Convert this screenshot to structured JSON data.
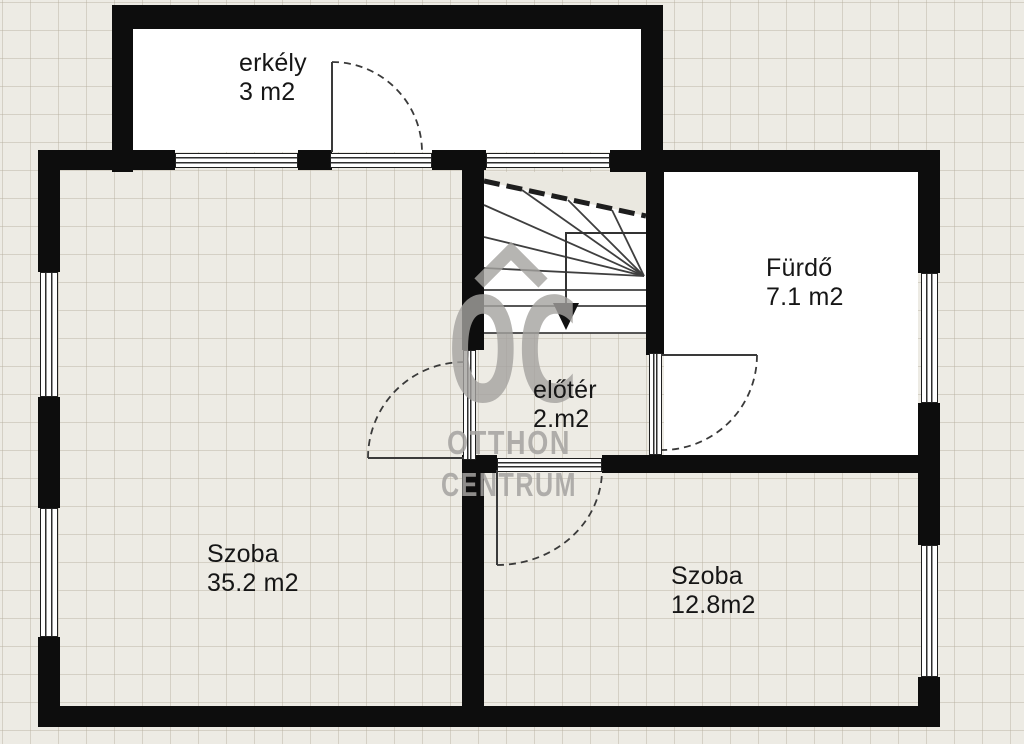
{
  "plan": {
    "rooms": [
      {
        "id": "balcony",
        "name": "erkély",
        "area": "3 m2"
      },
      {
        "id": "bathroom",
        "name": "Fürdő",
        "area": "7.1 m2"
      },
      {
        "id": "hall",
        "name": "előtér",
        "area": "2.m2"
      },
      {
        "id": "room-large",
        "name": "Szoba",
        "area": "35.2 m2"
      },
      {
        "id": "room-small",
        "name": "Szoba",
        "area": "12.8m2"
      }
    ],
    "watermark": {
      "monogram": "OC",
      "word1": "OTTHON",
      "word2": "CENTRUM"
    },
    "colors": {
      "background": "#edebe4",
      "grid": "#b2ac9b",
      "wall": "#0d0d0d",
      "room_fill": "#ffffff",
      "label_text": "#161616",
      "watermark": "#a5a3a0"
    }
  }
}
